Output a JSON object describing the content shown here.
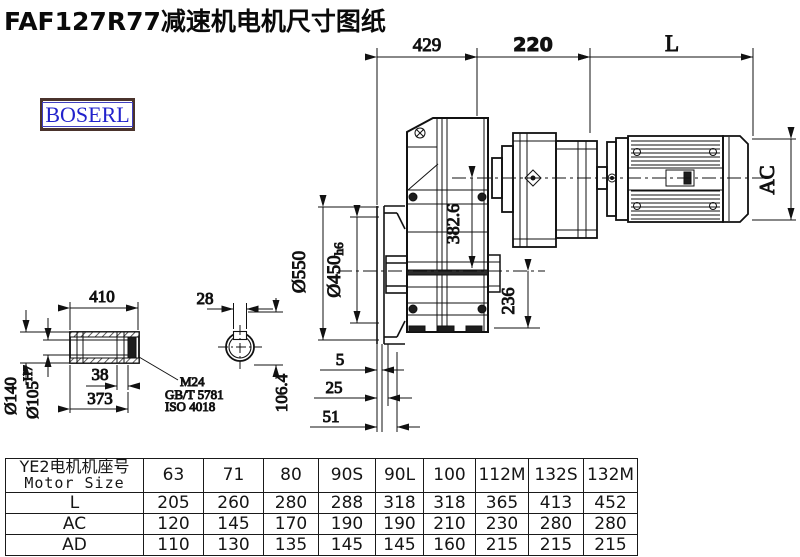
{
  "title": "FAF127R77减速机电机尺寸图纸",
  "brand": "BOSERL",
  "dims": {
    "width_gearbox": "429",
    "width_stage": "220",
    "motor_length": "L",
    "motor_ac": "AC",
    "flange_od": "Ø550",
    "flange_spigot": "Ø450",
    "flange_spigot_tol": "h6",
    "center_height": "382.6",
    "base_height": "236",
    "offset_5": "5",
    "offset_25": "25",
    "offset_51": "51",
    "shaft_length": "410",
    "shaft_groove": "38",
    "shaft_373": "373",
    "shaft_od": "Ø140",
    "bore": "Ø105",
    "bore_tol": "H7",
    "key_width": "28",
    "key_height": "106.4",
    "callout_line1": "M24",
    "callout_line2": "GB/T 5781",
    "callout_line3": "ISO 4018"
  },
  "table": {
    "header_cn": "YE2电机机座号",
    "header_en": "Motor Size",
    "columns": [
      "63",
      "71",
      "80",
      "90S",
      "90L",
      "100",
      "112M",
      "132S",
      "132M"
    ],
    "rows": [
      {
        "label": "L",
        "values": [
          "205",
          "260",
          "280",
          "288",
          "318",
          "318",
          "365",
          "413",
          "452"
        ]
      },
      {
        "label": "AC",
        "values": [
          "120",
          "145",
          "170",
          "190",
          "190",
          "210",
          "230",
          "280",
          "280"
        ]
      },
      {
        "label": "AD",
        "values": [
          "110",
          "130",
          "135",
          "145",
          "145",
          "160",
          "215",
          "215",
          "215"
        ]
      }
    ]
  }
}
